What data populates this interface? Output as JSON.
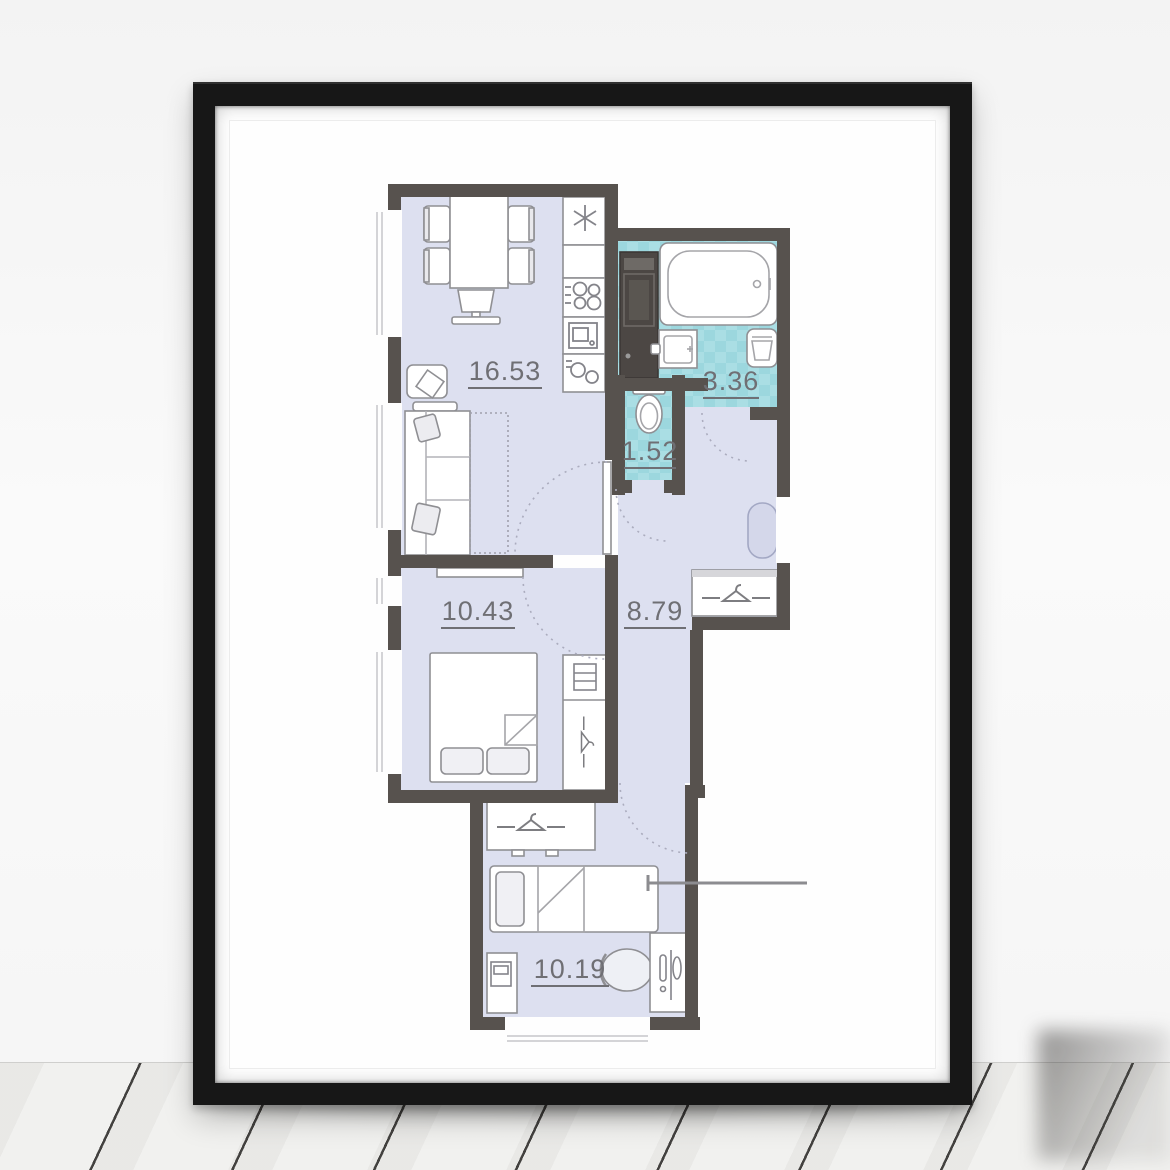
{
  "scene": {
    "description": "Black-framed poster of an apartment floor plan leaning on a white wall over a whitewashed wooden plank floor"
  },
  "plan": {
    "rooms": [
      {
        "name": "living-kitchen",
        "area": "16.53"
      },
      {
        "name": "bathroom",
        "area": "3.36"
      },
      {
        "name": "wc",
        "area": "1.52"
      },
      {
        "name": "bedroom",
        "area": "10.43"
      },
      {
        "name": "hallway",
        "area": "8.79"
      },
      {
        "name": "kids-room",
        "area": "10.19"
      }
    ],
    "colors": {
      "walls": "#57524e",
      "floor_fill": "#dde0f0",
      "tile": "#aadee4",
      "tile_alt": "#9cd7de",
      "furniture_outline": "#8f8f93",
      "labels": "#6f6f74",
      "washer": "#4c4744",
      "frame": "#171717",
      "mat": "#ffffff"
    },
    "icons": [
      "hanger-icon",
      "snowflake-icon",
      "hob-icon",
      "oven-icon",
      "kitchen-sink-icon",
      "shelf-icon",
      "lamp-icon",
      "bathtub",
      "toilet",
      "washer",
      "laundry-basket",
      "bathroom-sink",
      "sofa",
      "double-bed",
      "single-bed",
      "dining-table",
      "chair",
      "desk-chair",
      "pouf",
      "entry-door-marker"
    ]
  }
}
